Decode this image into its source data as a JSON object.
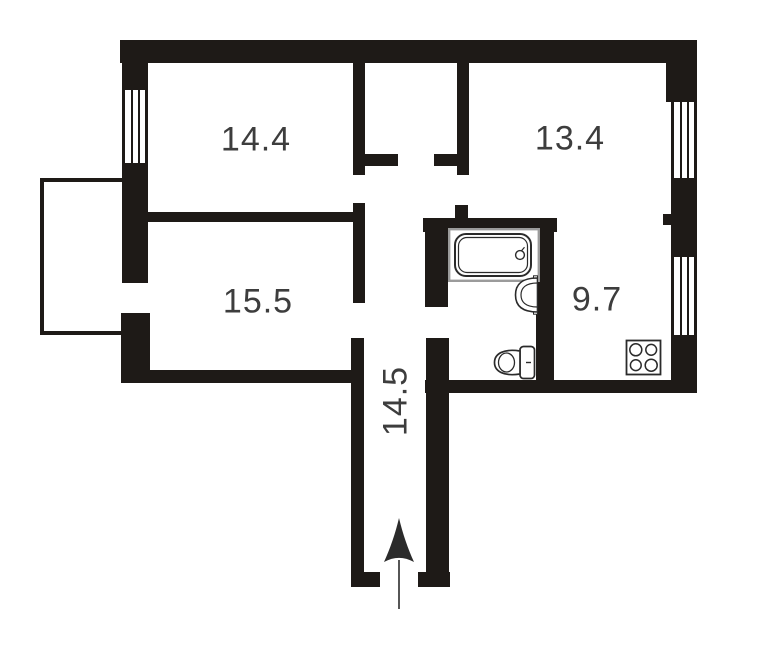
{
  "plan": {
    "type": "apartment-floor-plan",
    "rooms": [
      {
        "name": "room-top-left",
        "label": "14.4"
      },
      {
        "name": "room-top-right",
        "label": "13.4"
      },
      {
        "name": "room-mid-left",
        "label": "15.5"
      },
      {
        "name": "kitchen",
        "label": "9.7"
      },
      {
        "name": "hallway",
        "label": "14.5"
      }
    ],
    "fixtures": [
      {
        "name": "bathtub"
      },
      {
        "name": "washbasin"
      },
      {
        "name": "toilet"
      },
      {
        "name": "stove"
      },
      {
        "name": "balcony"
      },
      {
        "name": "entrance-arrow"
      },
      {
        "name": "window-left"
      },
      {
        "name": "window-right-top"
      },
      {
        "name": "window-right-bottom"
      }
    ],
    "colors": {
      "wall": "#1e1a17",
      "label": "#3d3d3d",
      "fixture_outline": "#2b2b2b",
      "tub_frame": "#9b9b9b",
      "background": "#ffffff"
    }
  }
}
